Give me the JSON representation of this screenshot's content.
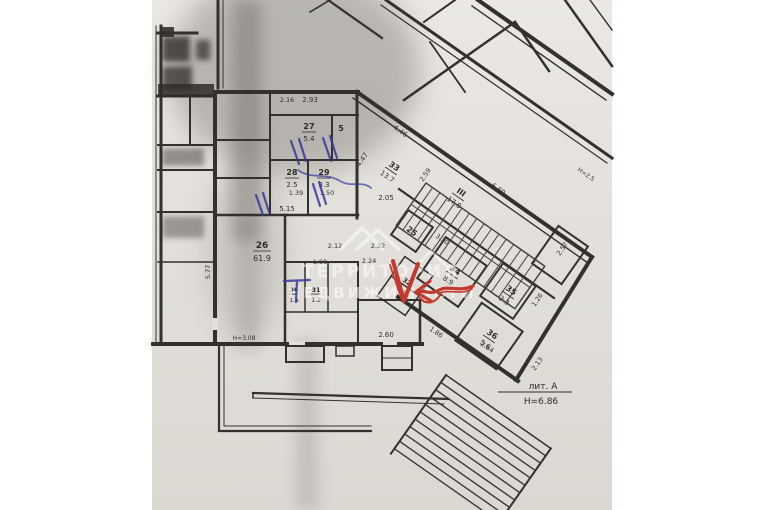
{
  "document": {
    "type": "scanned floor plan (technical inventory drawing)",
    "language": "ru"
  },
  "watermark": {
    "line1": "ТЕРРИТОРИЯ",
    "line2": "НЕДВИЖИМОСТИ",
    "logo": "roof-peaks-logo"
  },
  "labels": {
    "liter": "лит. А",
    "height_main": "Н=6.86",
    "height_right": "Н=2.5",
    "height_inner": "Н=3.08"
  },
  "rooms": [
    {
      "number": "27",
      "area": "5.4"
    },
    {
      "number": "5",
      "area": ""
    },
    {
      "number": "28",
      "area": "2.5"
    },
    {
      "number": "29",
      "area": "3.3"
    },
    {
      "number": "26",
      "area": "61.9"
    },
    {
      "number": "30",
      "area": "1.5"
    },
    {
      "number": "31",
      "area": "1.2"
    },
    {
      "number": "32",
      "area": "0.9"
    },
    {
      "number": "33",
      "area": "13.7"
    },
    {
      "number": "III",
      "area": "17.8"
    },
    {
      "number": "25",
      "area": ""
    },
    {
      "number": "34",
      "area": "8.9"
    },
    {
      "number": "35",
      "area": "2.3"
    },
    {
      "number": "36",
      "area": "5.6"
    }
  ],
  "dims": [
    "2.16",
    "2.93",
    "1.39",
    "1.50",
    "5.15",
    "5.77",
    "1.99",
    "2.12",
    "2.24",
    "2.32",
    "2.05",
    "2.60",
    "4.46",
    "4.47",
    "2.59",
    "6.69",
    "3.30",
    "2.57",
    "1.86",
    "1.26",
    "2.64",
    "2.13"
  ],
  "annotations": {
    "red_pen": {
      "color": "#c23a2e",
      "marks": [
        "checkmark",
        "arrow-pointing-left"
      ]
    },
    "blue_pen": {
      "color": "#36389d",
      "marks": [
        "door-tick-marks",
        "t-mark",
        "scribble"
      ]
    }
  },
  "colors": {
    "paper": "#e7e4df",
    "ink": "#33312c",
    "background": "#ffffff"
  }
}
